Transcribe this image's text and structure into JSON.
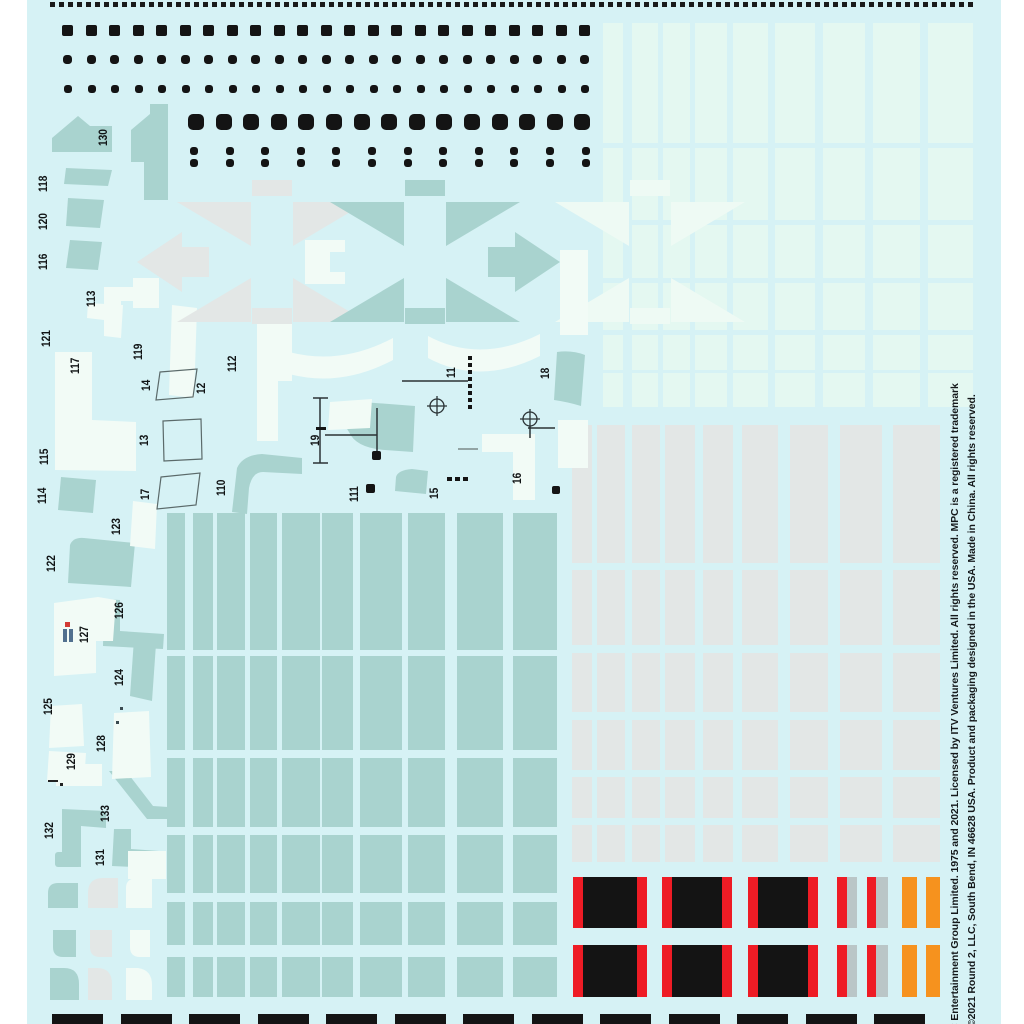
{
  "sheet": {
    "background": "#d6f2f5",
    "margin_color": "#ffffff",
    "colors": {
      "teal": "#a9d3cf",
      "gray": "#e3e7e6",
      "pale": "#e4f8f1",
      "cream": "#f2fbf6",
      "black": "#141414",
      "red": "#ee1c25",
      "orange": "#f6921e",
      "silver": "#bac6c7"
    },
    "copyright": {
      "line1": "C Entertainment Group Limited. 1975 and 2021. Licensed by ITV Ventures Limited. All rights reserved. MPC is a registered trademark",
      "line2": "©2021 Round 2, LLC, South Bend, IN 46628 USA.  Product and packaging designed in the USA.  Made in China.  All rights reserved."
    },
    "labels": [
      {
        "t": "130",
        "x": 98,
        "y": 146
      },
      {
        "t": "118",
        "x": 38,
        "y": 192
      },
      {
        "t": "120",
        "x": 38,
        "y": 230
      },
      {
        "t": "116",
        "x": 38,
        "y": 270
      },
      {
        "t": "113",
        "x": 86,
        "y": 307
      },
      {
        "t": "121",
        "x": 41,
        "y": 347
      },
      {
        "t": "117",
        "x": 70,
        "y": 374
      },
      {
        "t": "119",
        "x": 133,
        "y": 360
      },
      {
        "t": "112",
        "x": 227,
        "y": 372
      },
      {
        "t": "14",
        "x": 141,
        "y": 391
      },
      {
        "t": "12",
        "x": 196,
        "y": 394
      },
      {
        "t": "13",
        "x": 139,
        "y": 446
      },
      {
        "t": "11",
        "x": 446,
        "y": 378
      },
      {
        "t": "18",
        "x": 540,
        "y": 379
      },
      {
        "t": "19",
        "x": 310,
        "y": 446
      },
      {
        "t": "17",
        "x": 140,
        "y": 500
      },
      {
        "t": "110",
        "x": 216,
        "y": 496
      },
      {
        "t": "111",
        "x": 349,
        "y": 502
      },
      {
        "t": "15",
        "x": 429,
        "y": 499
      },
      {
        "t": "16",
        "x": 512,
        "y": 484
      },
      {
        "t": "115",
        "x": 39,
        "y": 465
      },
      {
        "t": "114",
        "x": 37,
        "y": 504
      },
      {
        "t": "123",
        "x": 111,
        "y": 535
      },
      {
        "t": "122",
        "x": 46,
        "y": 572
      },
      {
        "t": "126",
        "x": 114,
        "y": 619
      },
      {
        "t": "127",
        "x": 79,
        "y": 643
      },
      {
        "t": "124",
        "x": 114,
        "y": 686
      },
      {
        "t": "125",
        "x": 43,
        "y": 715
      },
      {
        "t": "128",
        "x": 96,
        "y": 752
      },
      {
        "t": "129",
        "x": 66,
        "y": 770
      },
      {
        "t": "133",
        "x": 100,
        "y": 822
      },
      {
        "t": "132",
        "x": 44,
        "y": 839
      },
      {
        "t": "131",
        "x": 95,
        "y": 866
      }
    ],
    "dot_rows": [
      {
        "name": "square-dot-row-1",
        "y": 25,
        "size": 11,
        "radius": 2,
        "x0": 62,
        "pitch": 23.5,
        "count": 23
      },
      {
        "name": "round-dot-row-2",
        "y": 55,
        "size": 9,
        "radius": 3.5,
        "x0": 63,
        "pitch": 23.5,
        "count": 23
      },
      {
        "name": "round-dot-row-3",
        "y": 85,
        "size": 8,
        "radius": 3,
        "x0": 64,
        "pitch": 23.5,
        "count": 23
      },
      {
        "name": "large-square-dot-row",
        "y": 114,
        "size": 16,
        "radius": 5,
        "x0": 188,
        "pitch": 27.6,
        "count": 15
      },
      {
        "name": "paired-dot-row",
        "y": 147,
        "size": 8,
        "radius": 3,
        "x0": 190,
        "pitch": 35.6,
        "count": 12,
        "pair_gap": 12
      }
    ],
    "grids": [
      {
        "name": "teal-grid",
        "color": "teal",
        "cols": [
          [
            167,
            18
          ],
          [
            193,
            20
          ],
          [
            217,
            28
          ],
          [
            250,
            27
          ],
          [
            282,
            38
          ],
          [
            322,
            31
          ],
          [
            360,
            42
          ],
          [
            408,
            37
          ],
          [
            457,
            46
          ],
          [
            513,
            44
          ]
        ],
        "rows": [
          [
            513,
            137
          ],
          [
            656,
            94
          ],
          [
            758,
            69
          ],
          [
            835,
            58
          ],
          [
            902,
            43
          ],
          [
            957,
            40
          ]
        ]
      },
      {
        "name": "gray-grid",
        "color": "gray",
        "cols": [
          [
            572,
            20
          ],
          [
            597,
            28
          ],
          [
            632,
            28
          ],
          [
            665,
            30
          ],
          [
            703,
            30
          ],
          [
            742,
            36
          ],
          [
            790,
            38
          ],
          [
            840,
            42
          ],
          [
            893,
            47
          ]
        ],
        "rows": [
          [
            425,
            138
          ],
          [
            570,
            75
          ],
          [
            653,
            59
          ],
          [
            720,
            50
          ],
          [
            777,
            41
          ],
          [
            825,
            37
          ]
        ]
      },
      {
        "name": "pale-grid",
        "color": "pale",
        "cols": [
          [
            603,
            20
          ],
          [
            632,
            26
          ],
          [
            663,
            27
          ],
          [
            695,
            32
          ],
          [
            733,
            35
          ],
          [
            775,
            40
          ],
          [
            823,
            42
          ],
          [
            873,
            47
          ],
          [
            928,
            45
          ]
        ],
        "rows": [
          [
            23,
            120
          ],
          [
            148,
            72
          ],
          [
            225,
            53
          ],
          [
            283,
            47
          ],
          [
            335,
            35
          ],
          [
            373,
            34
          ]
        ]
      }
    ],
    "stripe_rows": {
      "y": [
        877,
        945
      ],
      "heights": [
        51,
        52
      ],
      "segments": [
        {
          "x": 573,
          "w": 10,
          "c": "red"
        },
        {
          "x": 583,
          "w": 54,
          "c": "black"
        },
        {
          "x": 637,
          "w": 10,
          "c": "red"
        },
        {
          "x": 662,
          "w": 10,
          "c": "red"
        },
        {
          "x": 672,
          "w": 50,
          "c": "black"
        },
        {
          "x": 722,
          "w": 10,
          "c": "red"
        },
        {
          "x": 748,
          "w": 10,
          "c": "red"
        },
        {
          "x": 758,
          "w": 50,
          "c": "black"
        },
        {
          "x": 808,
          "w": 10,
          "c": "red"
        },
        {
          "x": 837,
          "w": 10,
          "c": "red"
        },
        {
          "x": 847,
          "w": 10,
          "c": "silver"
        },
        {
          "x": 867,
          "w": 9,
          "c": "red"
        },
        {
          "x": 876,
          "w": 12,
          "c": "silver"
        },
        {
          "x": 902,
          "w": 15,
          "c": "orange"
        },
        {
          "x": 926,
          "w": 14,
          "c": "orange"
        }
      ]
    },
    "bottom_bars": {
      "y": 1014,
      "h": 12,
      "x0": 52,
      "w": 51,
      "pitch": 68.5,
      "count": 13
    }
  }
}
